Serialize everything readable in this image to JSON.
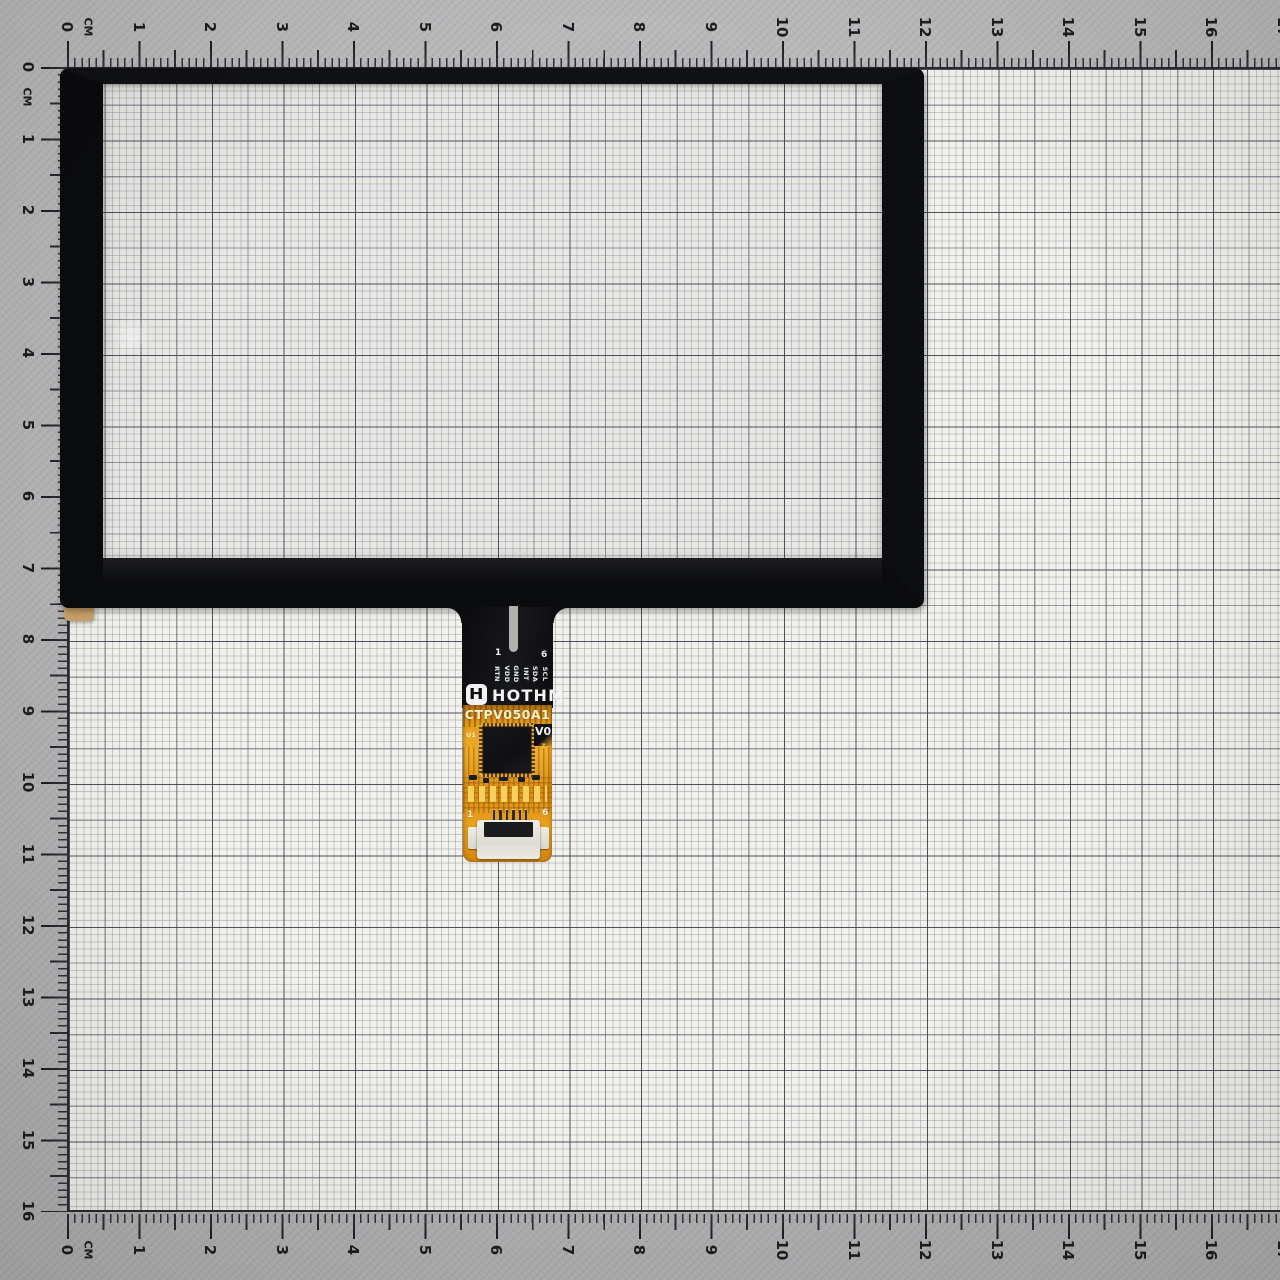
{
  "ruler": {
    "unit_label": "CM",
    "cm_pitch_px": 71.5,
    "origin_px": 67,
    "numbers": [
      "0",
      "1",
      "2",
      "3",
      "4",
      "5",
      "6",
      "7",
      "8",
      "9",
      "10",
      "11",
      "12",
      "13",
      "14",
      "15",
      "16",
      "17"
    ],
    "left_numbers_count": 17
  },
  "flex": {
    "brand": "HOTHM",
    "logo_glyph": "H",
    "model": "CTPV050A1",
    "version": "V0",
    "version_sub": "z",
    "chip_ref": "U1",
    "top_pin_numbers": {
      "first": "1",
      "last": "6"
    },
    "pin_labels": [
      "RTN",
      "VDD",
      "GND",
      "INT",
      "SDA",
      "SCL"
    ],
    "connector_pin_numbers": {
      "first": "1",
      "last": "6"
    }
  },
  "colors": {
    "paper": "#f2f1ec",
    "margin_gray": "#b5b5b7",
    "bezel_black": "#0b0c0e",
    "flex_gold": "#e59c1b",
    "connector_white": "#eceae3",
    "tick_black": "#1e1f22"
  }
}
